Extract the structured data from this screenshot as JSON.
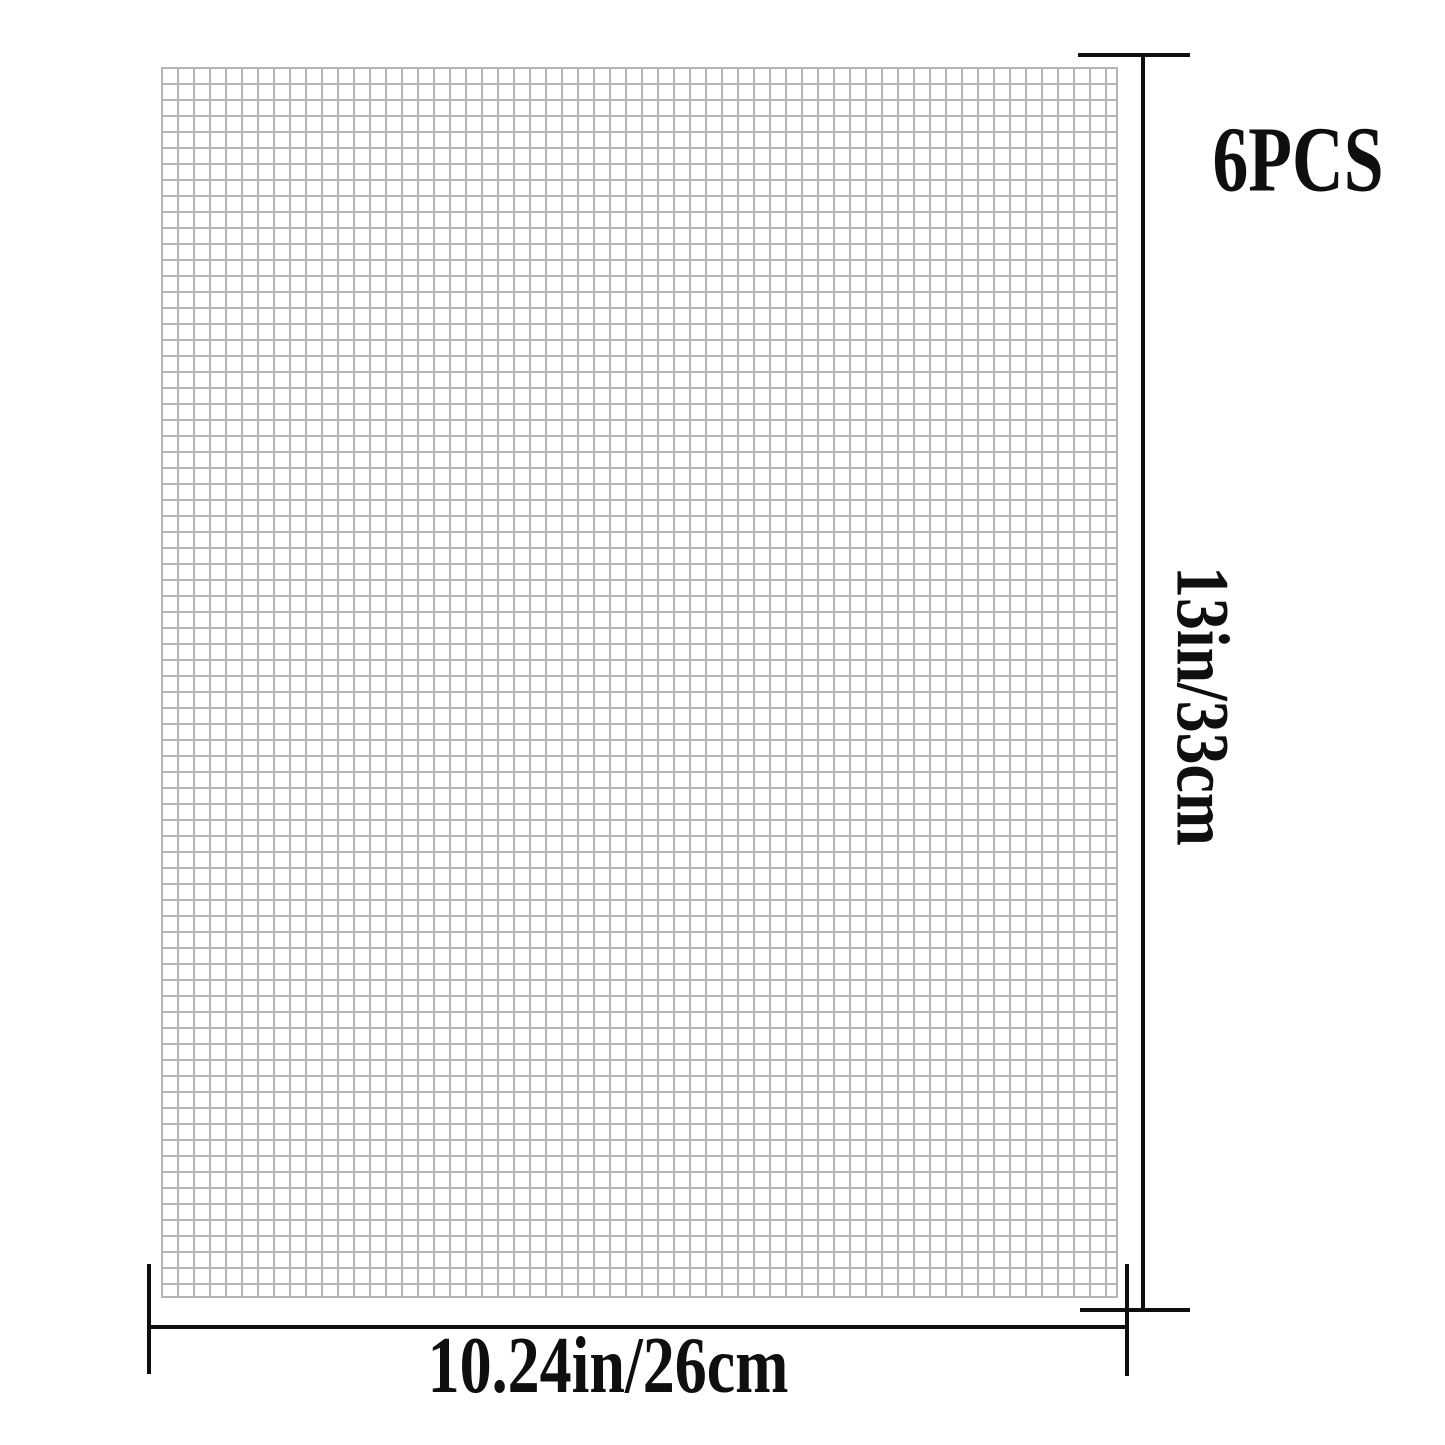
{
  "diagram": {
    "background_color": "#ffffff",
    "labels": {
      "pieces_count": "6PCS",
      "height_dimension": "13in/33cm",
      "width_dimension": "10.24in/26cm"
    },
    "mesh": {
      "grid_line_color": "#b5b5b5"
    },
    "dimension_lines": {
      "line_color": "#0f0f0f",
      "text_color": "#0f0f0f"
    }
  }
}
